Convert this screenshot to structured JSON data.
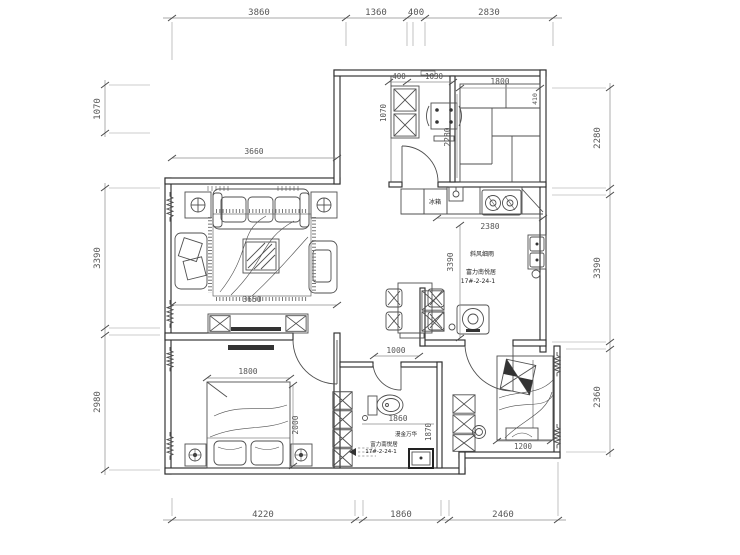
{
  "colors": {
    "background": "#ffffff",
    "line": "#4f4f4f",
    "wall": "#2e2e2e",
    "dim_text": "#565656",
    "annotation": "#222222"
  },
  "dims": {
    "top": [
      "3860",
      "1360",
      "400",
      "2830"
    ],
    "bottom": [
      "4220",
      "1860",
      "2460"
    ],
    "left": [
      "1070",
      "3390",
      "2980"
    ],
    "right": [
      "2280",
      "3390",
      "2360"
    ]
  },
  "inner_dims": {
    "living_top": "3660",
    "living_bottom": "3650",
    "balcony_width": "1800",
    "balcony_height": "2280",
    "balcony_edge": "410",
    "entry_cabinet": "400",
    "entry_opening": "1030",
    "entry_height": "1070",
    "counter": "2380",
    "kitchen_height": "3390",
    "dining": "1000",
    "bed_left_width": "1800",
    "bed_left_depth": "2000",
    "bath_width": "1860",
    "bath_depth": "1870",
    "bed_right_width": "1200"
  },
  "labels": {
    "fridge": "冰箱",
    "center_note": {
      "line1": "斜风细雨",
      "line2": "富力南悦居",
      "line3": "17#-2-24-1"
    },
    "bath_note": {
      "line1": "漫金万华",
      "line2": "富力南悦居",
      "line3": "17#-2-24-1"
    }
  }
}
